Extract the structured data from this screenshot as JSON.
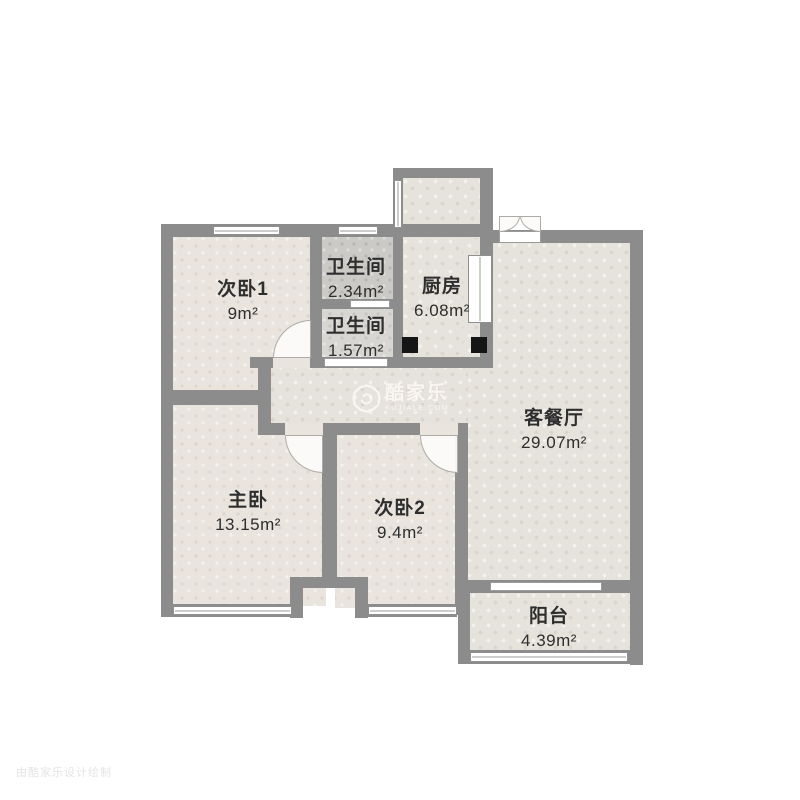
{
  "rooms": [
    {
      "name": "次卧1",
      "area": "9m²"
    },
    {
      "name": "卫生间",
      "area": "2.34m²"
    },
    {
      "name": "厨房",
      "area": "6.08m²"
    },
    {
      "name": "卫生间",
      "area": "1.57m²"
    },
    {
      "name": "客餐厅",
      "area": "29.07m²"
    },
    {
      "name": "主卧",
      "area": "13.15m²"
    },
    {
      "name": "次卧2",
      "area": "9.4m²"
    },
    {
      "name": "阳台",
      "area": "4.39m²"
    }
  ],
  "watermark": {
    "brand": "酷家乐",
    "domain": "KUJIALE.COM"
  },
  "corner_watermark": {
    "text": "由酷家乐设计绘制"
  },
  "colors": {
    "wall": "#8c8c8c",
    "floor_light": "#e6e2dc",
    "floor_warm": "#e9e4de",
    "tile_dark": "#cbcac7",
    "tile_light": "#d8d6d2",
    "flue": "#151515",
    "label_text": "#2e2e2e"
  }
}
